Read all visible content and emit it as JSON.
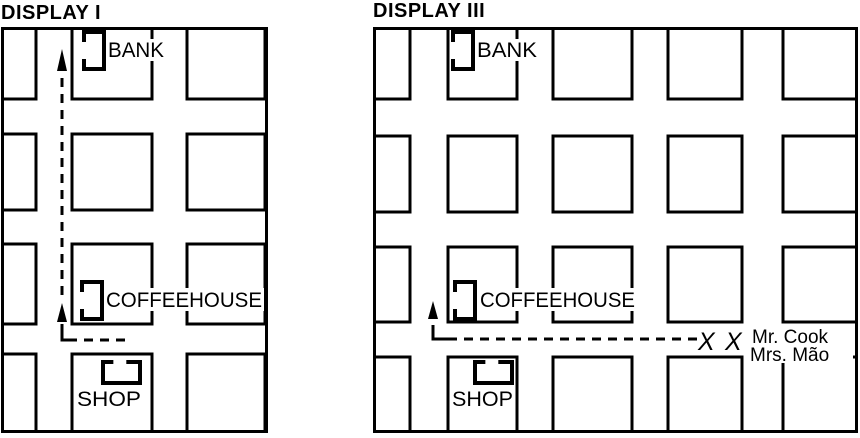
{
  "figure": {
    "background": "#ffffff",
    "ink": "#000000",
    "description": "Two scanned street-grid map displays with a bank, coffeehouse and shop, and dashed route arrows"
  },
  "displays": [
    {
      "id": "display-1-map",
      "title": "DISPLAY I",
      "map": {
        "width": 267,
        "height": 406,
        "blocks": [
          [
            0,
            0,
            35,
            72
          ],
          [
            71,
            0,
            80,
            72
          ],
          [
            186,
            0,
            78,
            72
          ],
          [
            0,
            107,
            35,
            76
          ],
          [
            71,
            107,
            80,
            76
          ],
          [
            186,
            107,
            78,
            76
          ],
          [
            0,
            217,
            35,
            80
          ],
          [
            71,
            217,
            80,
            80
          ],
          [
            186,
            217,
            78,
            80
          ],
          [
            0,
            327,
            35,
            79
          ],
          [
            71,
            327,
            80,
            79
          ],
          [
            186,
            327,
            78,
            79
          ]
        ],
        "label_masks": [
          [
            105,
            12,
            64,
            22
          ],
          [
            103,
            261,
            160,
            23
          ],
          [
            74,
            360,
            68,
            22
          ]
        ],
        "buildings": [
          {
            "name": "bank",
            "label": "BANK",
            "icon": {
              "type": "door-left",
              "x": 83,
              "y": 5,
              "w": 20,
              "h": 37
            },
            "lx": 107,
            "ly": 30,
            "lw": 56
          },
          {
            "name": "coffeehouse",
            "label": "COFFEEHOUSE",
            "icon": {
              "type": "door-left",
              "x": 81,
              "y": 255,
              "w": 20,
              "h": 37
            },
            "lx": 105,
            "ly": 280,
            "lw": 156
          },
          {
            "name": "shop",
            "label": "SHOP",
            "icon": {
              "type": "door-top",
              "x": 102,
              "y": 335,
              "w": 37,
              "h": 21
            },
            "lx": 76,
            "ly": 379,
            "lw": 64
          }
        ],
        "route": {
          "dashed": [
            [
              [
                124,
                313
              ],
              [
                66,
                313
              ]
            ],
            [
              [
                61,
                268
              ],
              [
                61,
                46
              ]
            ]
          ],
          "solid": [
            [
              [
                72,
                313
              ],
              [
                61,
                313
              ],
              [
                61,
                297
              ]
            ]
          ],
          "arrows": [
            {
              "tip": [
                61,
                276
              ],
              "base": 295
            },
            {
              "tip": [
                61,
                22
              ],
              "base": 44
            }
          ]
        },
        "annotations": []
      }
    },
    {
      "id": "display-3-map",
      "title": "DISPLAY III",
      "map": {
        "width": 485,
        "height": 406,
        "blocks": [
          [
            0,
            0,
            37,
            72
          ],
          [
            75,
            0,
            69,
            72
          ],
          [
            180,
            0,
            79,
            72
          ],
          [
            295,
            0,
            74,
            72
          ],
          [
            410,
            0,
            74,
            72
          ],
          [
            0,
            109,
            37,
            76
          ],
          [
            75,
            109,
            69,
            76
          ],
          [
            180,
            109,
            79,
            76
          ],
          [
            295,
            109,
            74,
            76
          ],
          [
            410,
            109,
            74,
            76
          ],
          [
            0,
            220,
            37,
            75
          ],
          [
            75,
            220,
            69,
            75
          ],
          [
            180,
            220,
            79,
            75
          ],
          [
            295,
            220,
            74,
            75
          ],
          [
            410,
            220,
            74,
            75
          ],
          [
            0,
            330,
            37,
            76
          ],
          [
            75,
            330,
            69,
            76
          ],
          [
            180,
            330,
            79,
            76
          ],
          [
            295,
            330,
            74,
            76
          ],
          [
            410,
            330,
            74,
            76
          ]
        ],
        "label_masks": [
          [
            101,
            12,
            67,
            22
          ],
          [
            104,
            261,
            161,
            23
          ],
          [
            77,
            360,
            65,
            22
          ],
          [
            374,
            298,
            106,
            38
          ]
        ],
        "buildings": [
          {
            "name": "bank",
            "label": "BANK",
            "icon": {
              "type": "door-left",
              "x": 80,
              "y": 5,
              "w": 20,
              "h": 37
            },
            "lx": 104,
            "ly": 30,
            "lw": 60
          },
          {
            "name": "coffeehouse",
            "label": "COFFEEHOUSE",
            "icon": {
              "type": "door-left",
              "x": 82,
              "y": 255,
              "w": 20,
              "h": 37
            },
            "lx": 107,
            "ly": 280,
            "lw": 155
          },
          {
            "name": "shop",
            "label": "SHOP",
            "icon": {
              "type": "door-top",
              "x": 102,
              "y": 335,
              "w": 37,
              "h": 21
            },
            "lx": 79,
            "ly": 379,
            "lw": 61
          }
        ],
        "route": {
          "dashed": [
            [
              [
                324,
                312
              ],
              [
                71,
                312
              ]
            ]
          ],
          "solid": [
            [
              [
                76,
                312
              ],
              [
                60,
                312
              ],
              [
                60,
                298
              ]
            ]
          ],
          "arrows": [
            {
              "tip": [
                60,
                274
              ],
              "base": 292
            }
          ]
        },
        "annotations": [
          {
            "name": "pedestrian-x-mark-1",
            "cls": "x-mark",
            "text": "X",
            "x": 325,
            "y": 323
          },
          {
            "name": "pedestrian-x-mark-2",
            "cls": "x-mark",
            "text": "X",
            "x": 352,
            "y": 323
          },
          {
            "name": "person-label-mr-cook",
            "cls": "name",
            "text": "Mr. Cook",
            "x": 379,
            "y": 316
          },
          {
            "name": "person-label-mrs-mao",
            "cls": "name",
            "text": "Mrs. Mão",
            "x": 377,
            "y": 334
          }
        ]
      }
    }
  ]
}
